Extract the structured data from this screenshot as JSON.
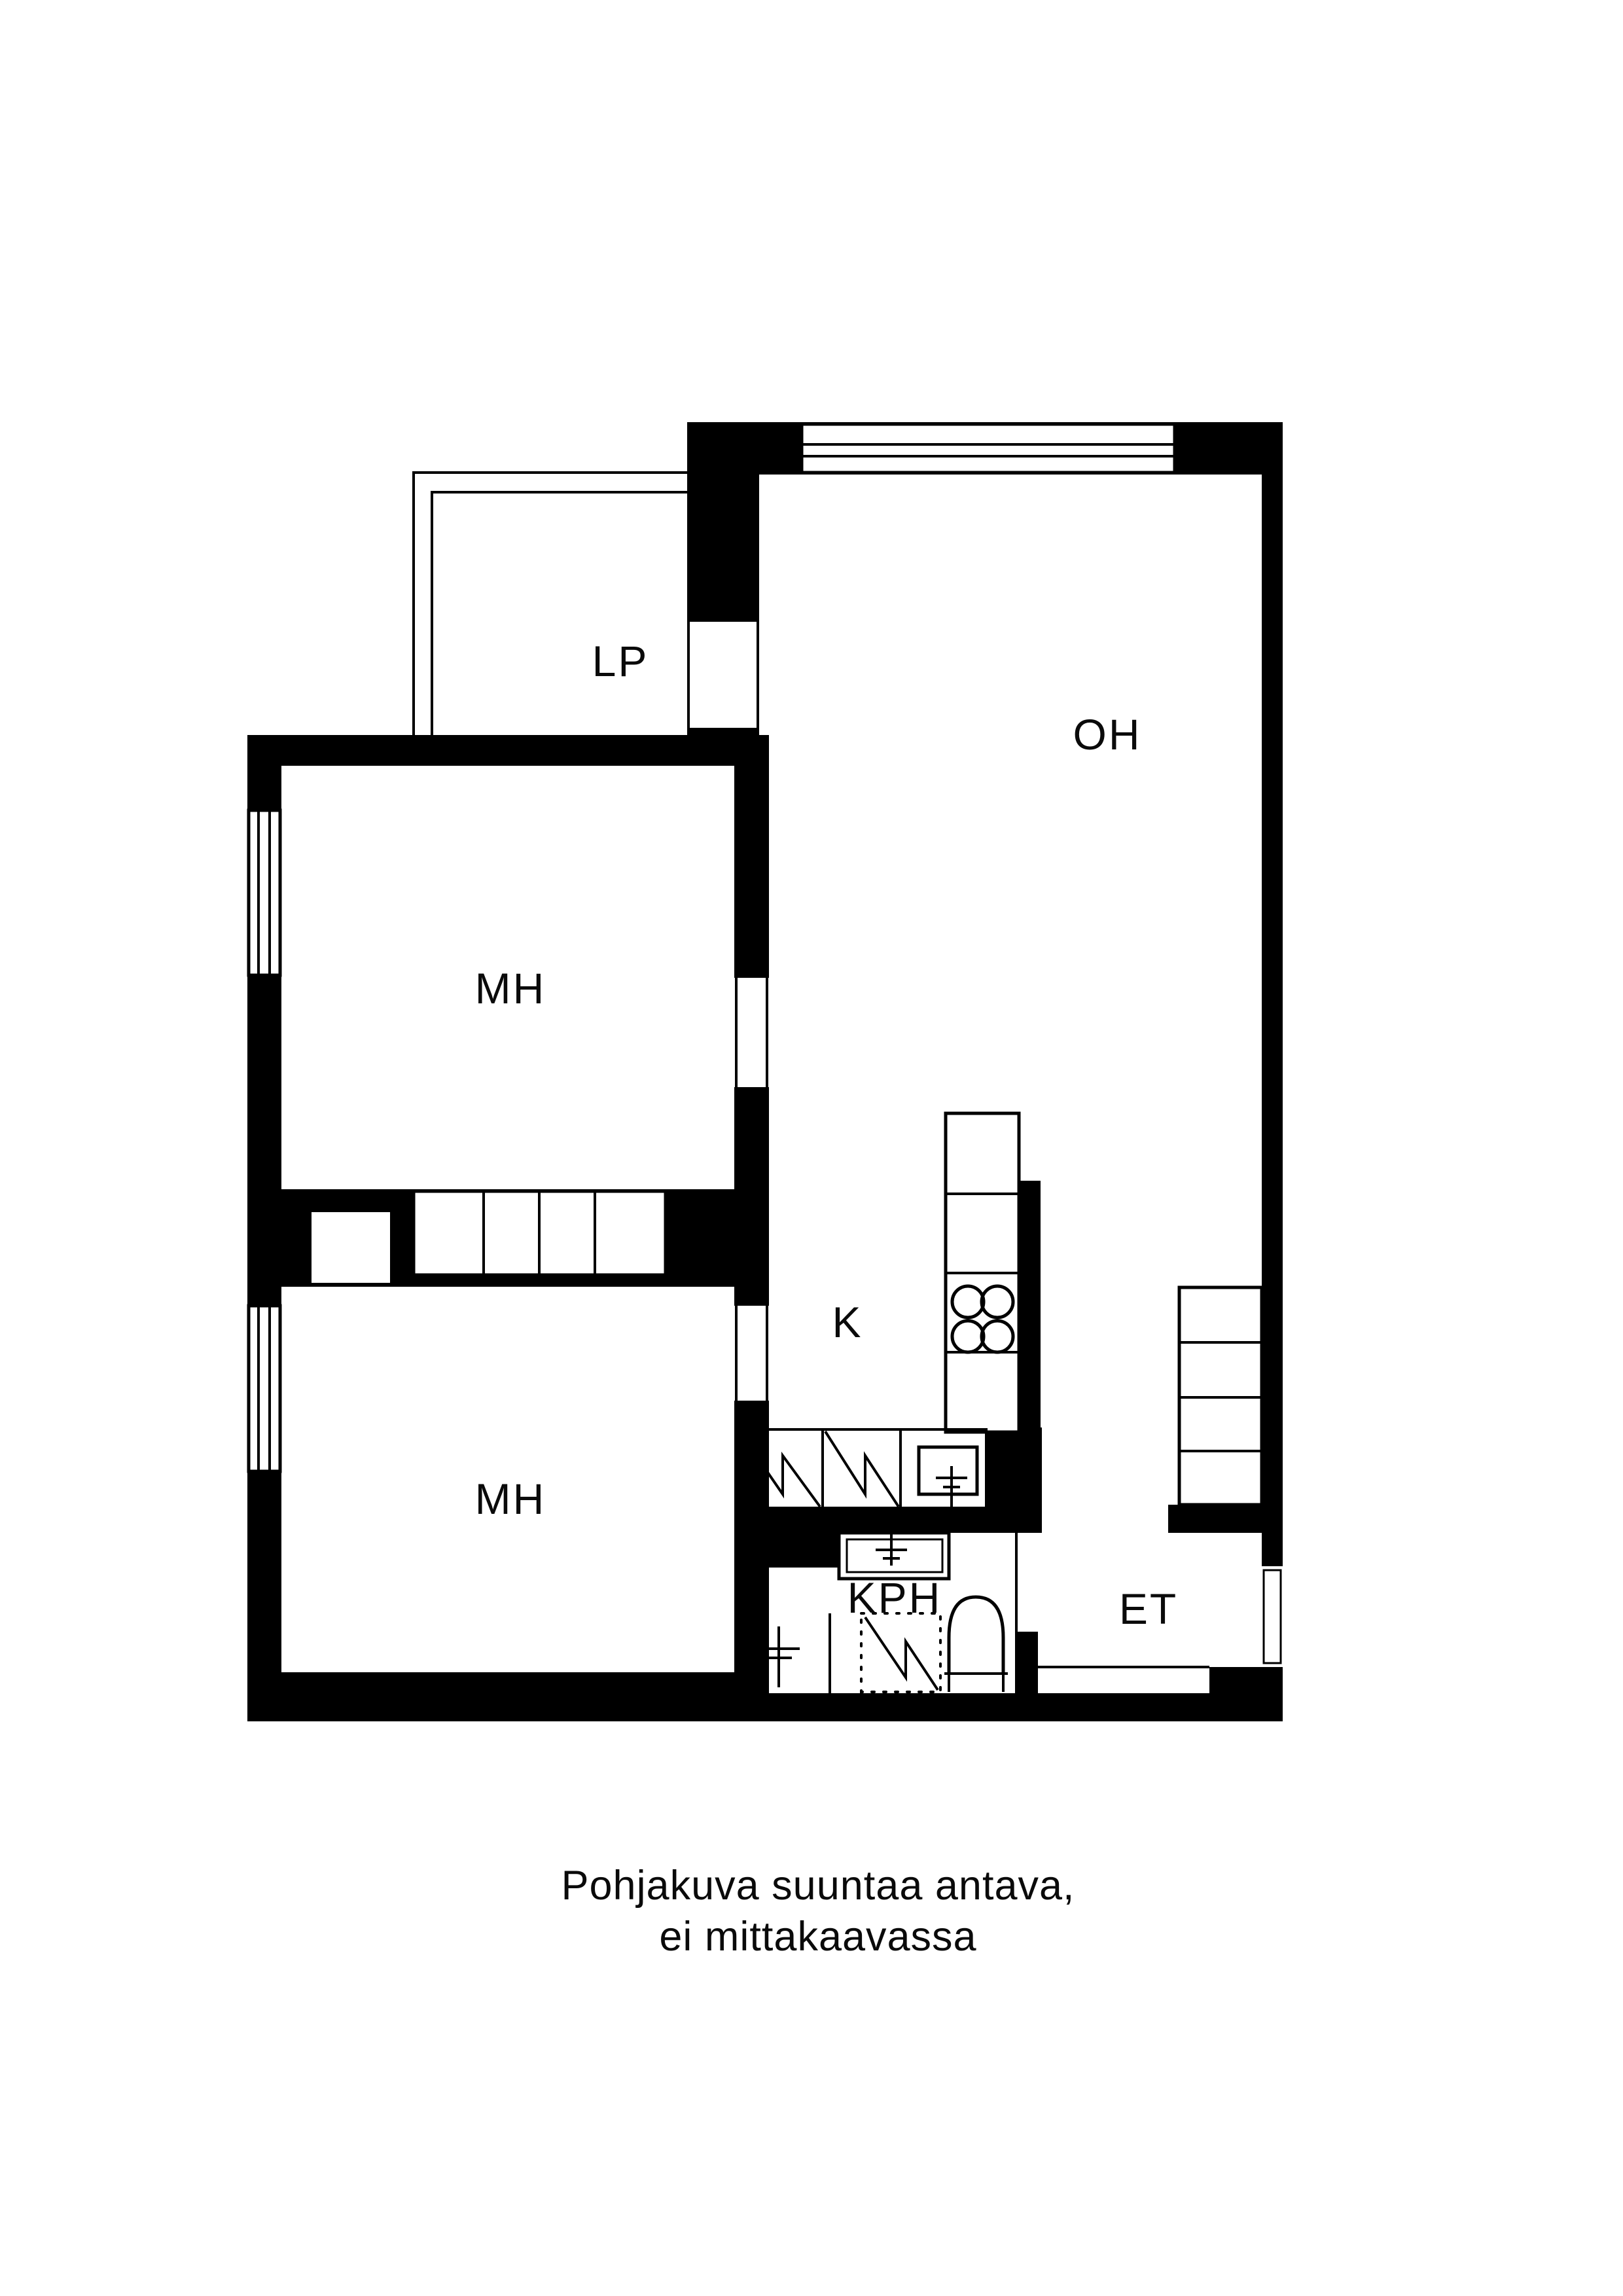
{
  "floor_plan": {
    "title_hidden": "",
    "rooms": [
      {
        "id": "lp",
        "label": "LP",
        "meaning": "parveke / balcony"
      },
      {
        "id": "oh",
        "label": "OH",
        "meaning": "olohuone / living room"
      },
      {
        "id": "mh-upper",
        "label": "MH",
        "meaning": "makuuhuone / bedroom"
      },
      {
        "id": "mh-lower",
        "label": "MH",
        "meaning": "makuuhuone / bedroom"
      },
      {
        "id": "k",
        "label": "K",
        "meaning": "keittiö / kitchen"
      },
      {
        "id": "kph",
        "label": "KPH",
        "meaning": "kylpyhuone / bathroom"
      },
      {
        "id": "et",
        "label": "ET",
        "meaning": "eteinen / entry hall"
      }
    ],
    "caption": {
      "line1": "Pohjakuva suuntaa antava,",
      "line2": "ei mittakaavassa"
    },
    "colors": {
      "wall": "#000000",
      "background": "#ffffff",
      "text": "#0a0a0a"
    }
  }
}
